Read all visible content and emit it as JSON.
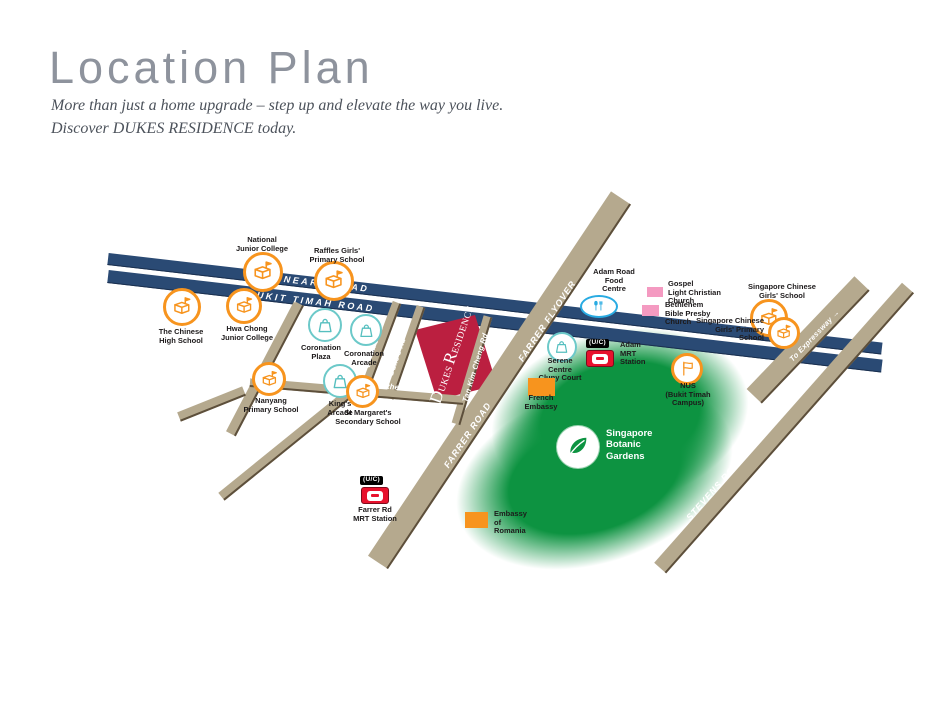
{
  "header": {
    "title": "Location Plan",
    "tagline_line1": "More than just a home upgrade – step up and elevate the way you live.",
    "tagline_line2": "Discover DUKES RESIDENCE today."
  },
  "colors": {
    "road_navy": "#2a4a74",
    "road_tan": "#b5a98e",
    "road_edge": "#5d4f3b",
    "residence_red": "#bb1f40",
    "school_orange": "#f7941e",
    "retail_teal": "#6cc9c9",
    "food_blue": "#29abe2",
    "church_pink": "#f49ac1",
    "embassy_orange": "#f7941e",
    "mrt_red": "#e8112d",
    "gardens_green": "#0d9341"
  },
  "roads": {
    "dunearn": "DUNEARN ROAD",
    "bukit_timah": "BUKIT TIMAH ROAD",
    "farrer_flyover": "FARRER FLYOVER",
    "farrer_road": "FARRER ROAD",
    "stevens": "STEVENS ROAD",
    "to_expressway": "To Expressway",
    "to_expressway_arrow": "→",
    "west_coronation": "West Coronation Rd",
    "queens": "Queen's Rd",
    "dukes": "Duke's Rd",
    "tan_kim_cheng": "Tan Kim Cheng Rd",
    "lutheran": "Lutheran Rd"
  },
  "residence": {
    "d": "D",
    "ukes": "UKES",
    "r": "R",
    "esidence": "ESIDENCE"
  },
  "pois": {
    "njc": {
      "label": "National\nJunior College"
    },
    "rgps": {
      "label": "Raffles Girls'\nPrimary School"
    },
    "chs": {
      "label": "The Chinese\nHigh School"
    },
    "hcjc": {
      "label": "Hwa Chong\nJunior College"
    },
    "cor_plaza": {
      "label": "Coronation\nPlaza"
    },
    "cor_arcade": {
      "label": "Coronation\nArcade"
    },
    "kings": {
      "label": "King's\nArcade"
    },
    "nanyang": {
      "label": "Nanyang\nPrimary School"
    },
    "st_margarets": {
      "label": "St Margaret's\nSecondary School"
    },
    "farrer_mrt": {
      "uc": "(U/C)",
      "label": "Farrer Rd\nMRT Station"
    },
    "adam_food": {
      "label": "Adam Road\nFood\nCentre"
    },
    "gospel": {
      "label": "Gospel\nLight Christian\nChurch"
    },
    "bethlehem": {
      "label": "Bethlehem\nBible Presby\nChurch"
    },
    "scgs": {
      "label": "Singapore Chinese\nGirls' School"
    },
    "scgps": {
      "label": "Singapore Chinese\nGirls' Primary\nSchool"
    },
    "adam_mrt": {
      "uc": "(U/C)",
      "label": "Adam\nMRT\nStation"
    },
    "serene": {
      "label": "Serene\nCentre\nCluny Court"
    },
    "french": {
      "label": "French\nEmbassy"
    },
    "nus": {
      "label": "NUS\n(Bukit Timah\nCampus)"
    },
    "gardens": {
      "label": "Singapore\nBotanic\nGardens"
    },
    "romania": {
      "label": "Embassy\nof\nRomania"
    }
  }
}
